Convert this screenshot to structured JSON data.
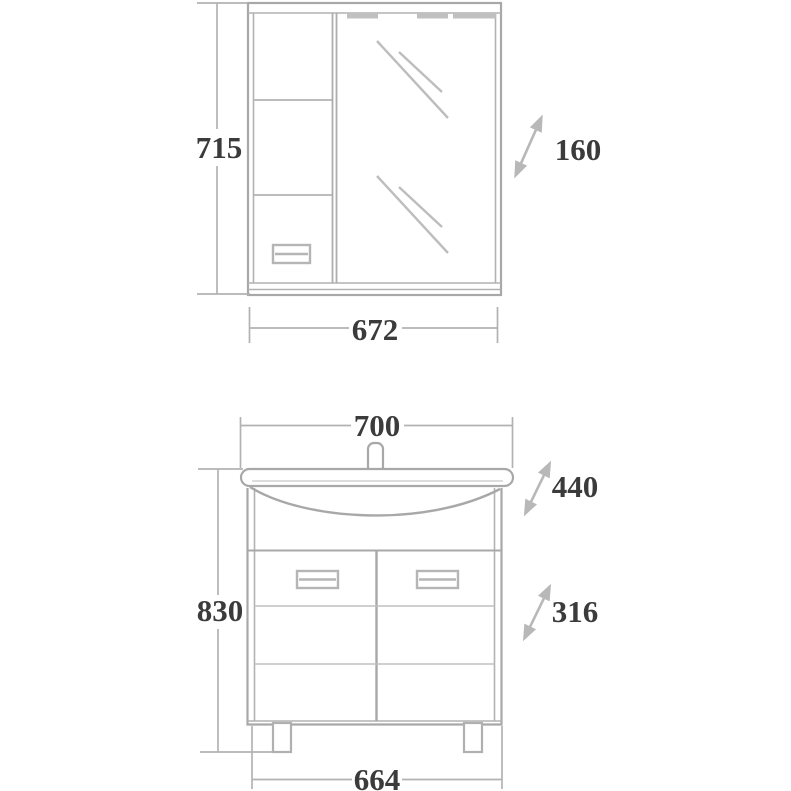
{
  "colors": {
    "object_line": "#a8a8a8",
    "inner_line": "#c0c0c0",
    "dim_line": "#b2b2b2",
    "arrow_fill": "#b8b8b8",
    "text": "#3b3b3b",
    "background": "#ffffff"
  },
  "mirror_cabinet": {
    "height_label": "715",
    "width_label": "672",
    "depth_label": "160"
  },
  "vanity": {
    "sink_width_label": "700",
    "sink_depth_label": "440",
    "height_label": "830",
    "base_width_label": "664",
    "base_depth_label": "316"
  }
}
